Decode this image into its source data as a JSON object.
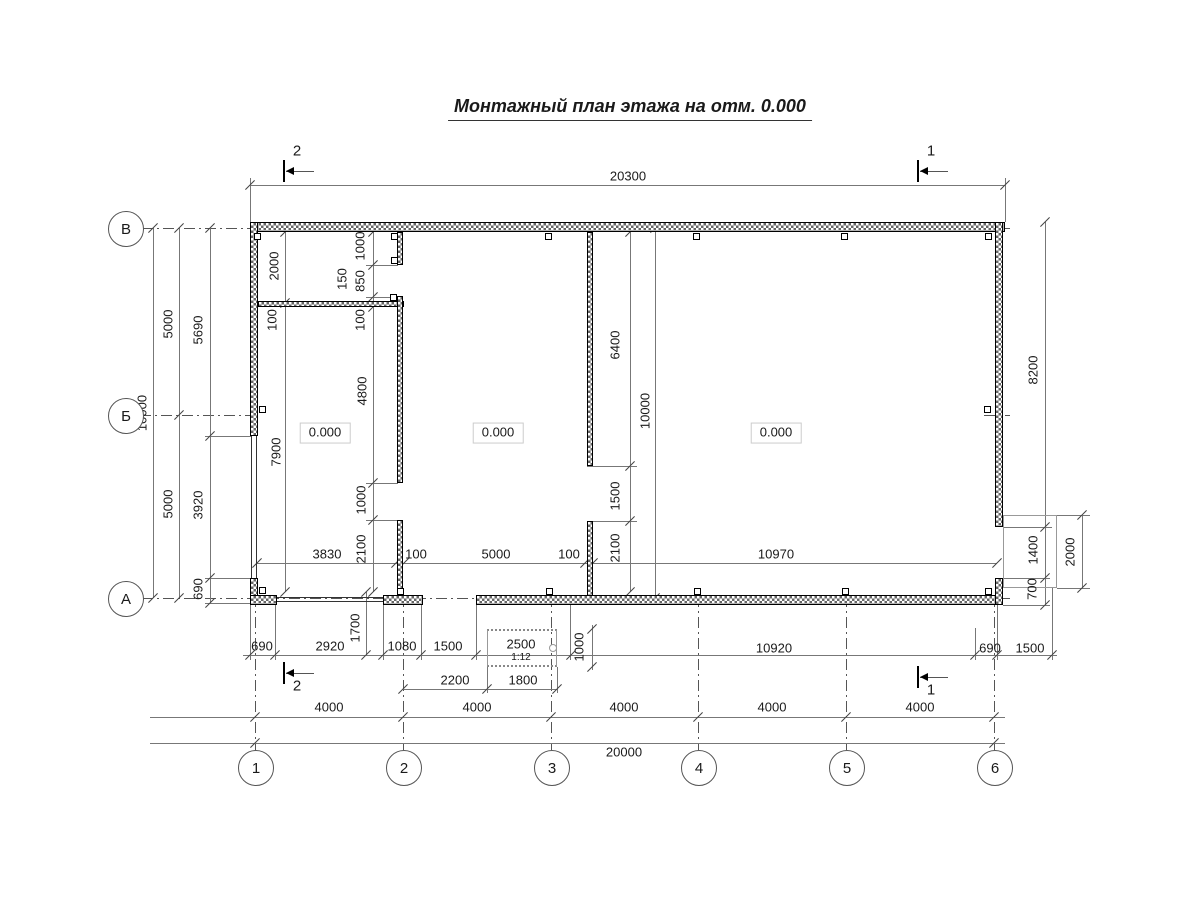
{
  "title": "Монтажный план этажа на отм. 0.000",
  "axes": {
    "rows": [
      {
        "label": "В",
        "y": 228
      },
      {
        "label": "Б",
        "y": 415
      },
      {
        "label": "А",
        "y": 598
      }
    ],
    "cols": [
      {
        "label": "1",
        "x": 255
      },
      {
        "label": "2",
        "x": 403
      },
      {
        "label": "3",
        "x": 551
      },
      {
        "label": "4",
        "x": 698
      },
      {
        "label": "5",
        "x": 846
      },
      {
        "label": "6",
        "x": 994
      }
    ]
  },
  "section_markers": [
    {
      "label": "2",
      "x": 283,
      "y": 171,
      "label_pos": "top"
    },
    {
      "label": "1",
      "x": 917,
      "y": 171,
      "label_pos": "top"
    },
    {
      "label": "2",
      "x": 283,
      "y": 673,
      "label_pos": "bottom"
    },
    {
      "label": "1",
      "x": 917,
      "y": 677,
      "label_pos": "bottom"
    }
  ],
  "room_marks": [
    {
      "text": "0.000",
      "x": 325,
      "y": 433
    },
    {
      "text": "0.000",
      "x": 498,
      "y": 433
    },
    {
      "text": "0.000",
      "x": 776,
      "y": 433
    }
  ],
  "ramp": {
    "dim": "2500",
    "slope": "1:12"
  },
  "dim_labels": [
    {
      "t": "20300",
      "x": 628,
      "y": 176,
      "r": 0
    },
    {
      "t": "10000",
      "x": 142,
      "y": 413,
      "r": 1
    },
    {
      "t": "5000",
      "x": 168,
      "y": 324,
      "r": 1
    },
    {
      "t": "5000",
      "x": 168,
      "y": 504,
      "r": 1
    },
    {
      "t": "5690",
      "x": 198,
      "y": 330,
      "r": 1
    },
    {
      "t": "3920",
      "x": 198,
      "y": 505,
      "r": 1
    },
    {
      "t": "690",
      "x": 198,
      "y": 589,
      "r": 1
    },
    {
      "t": "2000",
      "x": 274,
      "y": 266,
      "r": 1
    },
    {
      "t": "100",
      "x": 272,
      "y": 320,
      "r": 1
    },
    {
      "t": "7900",
      "x": 276,
      "y": 452,
      "r": 1
    },
    {
      "t": "1000",
      "x": 360,
      "y": 246,
      "r": 1
    },
    {
      "t": "850",
      "x": 360,
      "y": 281,
      "r": 1
    },
    {
      "t": "150",
      "x": 342,
      "y": 279,
      "r": 1
    },
    {
      "t": "100",
      "x": 360,
      "y": 320,
      "r": 1
    },
    {
      "t": "4800",
      "x": 362,
      "y": 391,
      "r": 1
    },
    {
      "t": "1000",
      "x": 361,
      "y": 500,
      "r": 1
    },
    {
      "t": "2100",
      "x": 361,
      "y": 549,
      "r": 1
    },
    {
      "t": "1700",
      "x": 355,
      "y": 628,
      "r": 1
    },
    {
      "t": "6400",
      "x": 615,
      "y": 345,
      "r": 1
    },
    {
      "t": "1500",
      "x": 615,
      "y": 496,
      "r": 1
    },
    {
      "t": "2100",
      "x": 615,
      "y": 548,
      "r": 1
    },
    {
      "t": "10000",
      "x": 645,
      "y": 411,
      "r": 1
    },
    {
      "t": "1000",
      "x": 579,
      "y": 647,
      "r": 1
    },
    {
      "t": "8200",
      "x": 1033,
      "y": 370,
      "r": 1
    },
    {
      "t": "1400",
      "x": 1033,
      "y": 550,
      "r": 1
    },
    {
      "t": "700",
      "x": 1032,
      "y": 589,
      "r": 1
    },
    {
      "t": "2000",
      "x": 1070,
      "y": 552,
      "r": 1
    },
    {
      "t": "3830",
      "x": 327,
      "y": 554,
      "r": 0
    },
    {
      "t": "100",
      "x": 416,
      "y": 554,
      "r": 0
    },
    {
      "t": "5000",
      "x": 496,
      "y": 554,
      "r": 0
    },
    {
      "t": "100",
      "x": 569,
      "y": 554,
      "r": 0
    },
    {
      "t": "10970",
      "x": 776,
      "y": 554,
      "r": 0
    },
    {
      "t": "690",
      "x": 262,
      "y": 646,
      "r": 0
    },
    {
      "t": "2920",
      "x": 330,
      "y": 646,
      "r": 0
    },
    {
      "t": "1080",
      "x": 402,
      "y": 646,
      "r": 0
    },
    {
      "t": "1500",
      "x": 448,
      "y": 646,
      "r": 0
    },
    {
      "t": "10920",
      "x": 774,
      "y": 648,
      "r": 0
    },
    {
      "t": "690",
      "x": 990,
      "y": 648,
      "r": 0
    },
    {
      "t": "1500",
      "x": 1030,
      "y": 648,
      "r": 0
    },
    {
      "t": "2200",
      "x": 455,
      "y": 680,
      "r": 0
    },
    {
      "t": "1800",
      "x": 523,
      "y": 680,
      "r": 0
    },
    {
      "t": "4000",
      "x": 329,
      "y": 707,
      "r": 0
    },
    {
      "t": "4000",
      "x": 477,
      "y": 707,
      "r": 0
    },
    {
      "t": "4000",
      "x": 624,
      "y": 707,
      "r": 0
    },
    {
      "t": "4000",
      "x": 772,
      "y": 707,
      "r": 0
    },
    {
      "t": "4000",
      "x": 920,
      "y": 707,
      "r": 0
    },
    {
      "t": "20000",
      "x": 624,
      "y": 752,
      "r": 0
    }
  ],
  "colors": {
    "line": "#777777",
    "wall_hatch": "#666666",
    "text": "#1a1a1a"
  }
}
